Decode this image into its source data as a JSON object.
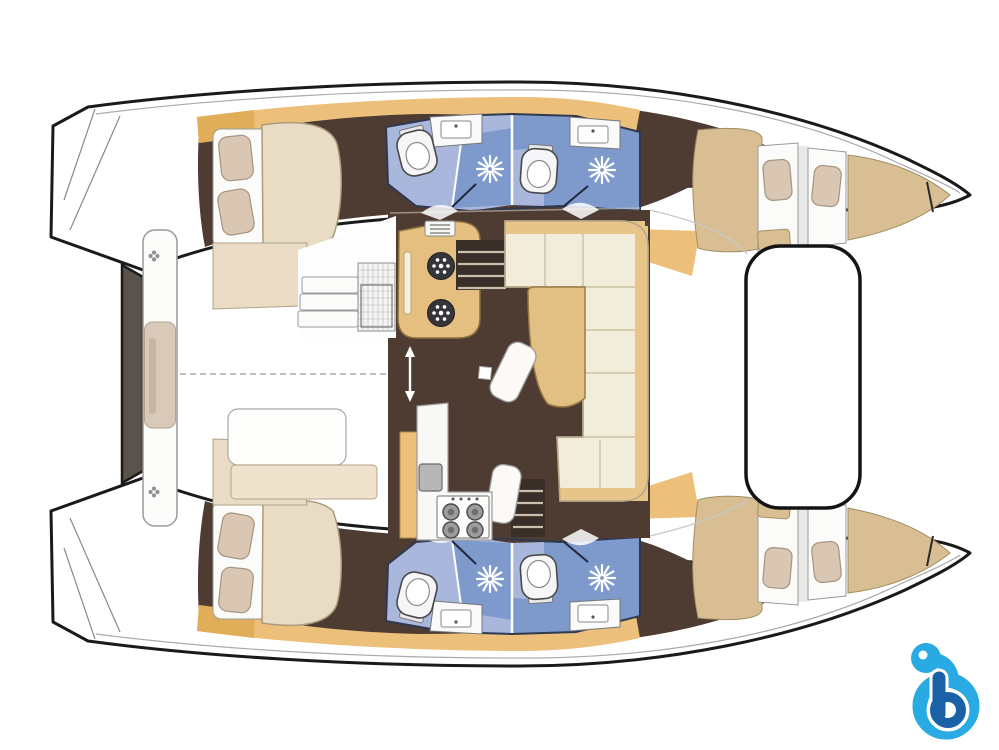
{
  "meta": {
    "width": 999,
    "height": 750,
    "kind": "boat-floor-plan",
    "description": "Top-down interior layout plan of a 4-cabin, 4-head sailing catamaran, bows pointing right, no visible text"
  },
  "labels": {
    "diagram": "Catamaran interior layout plan",
    "port_hull": "Port hull (top): aft double cabin, two heads with showers, forward berths",
    "starboard_hull": "Starboard hull (bottom): aft double cabin, two heads with showers, forward berths",
    "salon": "Central salon with galley, U-shaped settee and table",
    "aft_cabin": "Aft double cabin with pillows and mattress",
    "forward_cabin": "Forward double berth",
    "head_aft": "Aft head with toilet, sink and shower",
    "head_forward": "Forward head with toilet, sink and shower",
    "galley_island": "Galley island with two burners",
    "stove": "Four-burner stove with sink appliance",
    "settee": "U-shaped salon settee",
    "salon_table": "Salon table",
    "stairs": "Companionway steps down to hull",
    "cockpit_bench": "Aft cockpit bench",
    "transom": "Transom steps",
    "forward_cockpit": "Forward cockpit platform",
    "centerline": "Hull centerline",
    "watermark": "Blue letter b watermark logo"
  },
  "watermark": {
    "letter": "b"
  },
  "palette": {
    "outline": "#1a1a1a",
    "deck_line": "#aaaaaa",
    "floor": "#4e3c32",
    "wood": "#ecc07a",
    "wood_deep": "#e0ae58",
    "mattress": "#d8be92",
    "bed_cream": "#e8dcc4",
    "pillow": "#d9c6b3",
    "pillow_edge": "#a5947f",
    "sofa": "#f2ecda",
    "sofa_edge": "#b5a88a",
    "sofa_back": "#e7c588",
    "table": "#e2c083",
    "bath": "#a9b7dc",
    "shower": "#7e99cc",
    "bath_edge": "#2e3850",
    "fixture": "#f6f6f8",
    "stair": "#3a2f28",
    "tread": "#cdbfae",
    "bench_mid": "#d9c9b9",
    "panel_gray": "#59534c",
    "logo_light": "#2aaae2",
    "logo_dark": "#1b61a8"
  }
}
